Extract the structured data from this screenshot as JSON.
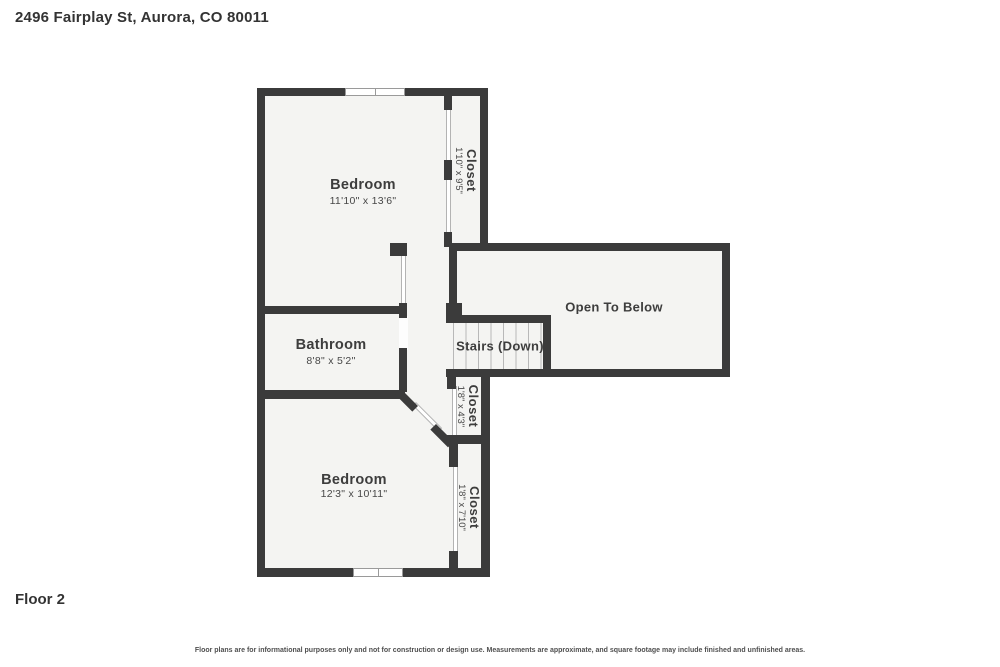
{
  "header": {
    "address": "2496 Fairplay St, Aurora, CO 80011"
  },
  "footer": {
    "floor_label": "Floor 2",
    "disclaimer": "Floor plans are for informational purposes only and not for construction or design use. Measurements are approximate, and square footage may include finished and unfinished areas."
  },
  "rooms": {
    "bedroom_top": {
      "name": "Bedroom",
      "dims": "11'10\" x 13'6\""
    },
    "closet_top": {
      "name": "Closet",
      "dims": "1'10\" x 9'5\""
    },
    "open_to_below": {
      "name": "Open To Below"
    },
    "stairs": {
      "name": "Stairs (Down)"
    },
    "bathroom": {
      "name": "Bathroom",
      "dims": "8'8\" x 5'2\""
    },
    "closet_mid": {
      "name": "Closet",
      "dims": "1'8\" x 4'3\""
    },
    "bedroom_bottom": {
      "name": "Bedroom",
      "dims": "12'3\" x 10'11\""
    },
    "closet_bottom": {
      "name": "Closet",
      "dims": "1'8\" x 7'10\""
    }
  },
  "colors": {
    "wall": "#3b3b3b",
    "room_fill": "#f4f4f2",
    "background": "#ffffff",
    "text": "#3d3d3d"
  }
}
